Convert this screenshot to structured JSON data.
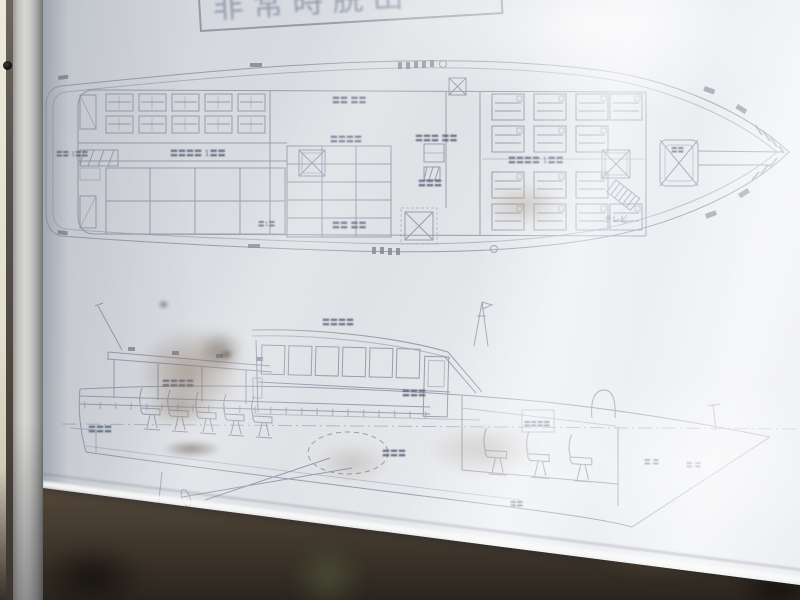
{
  "poster": {
    "title": "非常時脱出",
    "tv_label": "テレビ"
  },
  "deck_plan": {
    "labels": [
      "〓〓 〓〓",
      "〓〓〓 〓〓",
      "〓〓〓〓",
      "〓〓〓",
      "〓〓 〓〓",
      "〓〓〓〓 1〓〓",
      "〓〓·1〓〓",
      "〓〓〓〓 1〓〓",
      "〓〓",
      "〓1〓"
    ]
  },
  "side_view": {
    "labels": [
      "〓〓〓〓",
      "〓〓〓",
      "〓〓〓〓",
      "〓〓〓",
      "〓〓〓",
      "〓〓〓〓",
      "〓.〓",
      "〓.〓",
      "〓〓"
    ]
  },
  "colors": {
    "paper": "#dcdfe3",
    "ink": "#8b91a2",
    "ink_dark": "#6e7382",
    "frame_silver": "#c2c2c0",
    "wall_cream": "#ece9da",
    "backing_brown": "#4c4135",
    "stain_brown": "#685038"
  }
}
